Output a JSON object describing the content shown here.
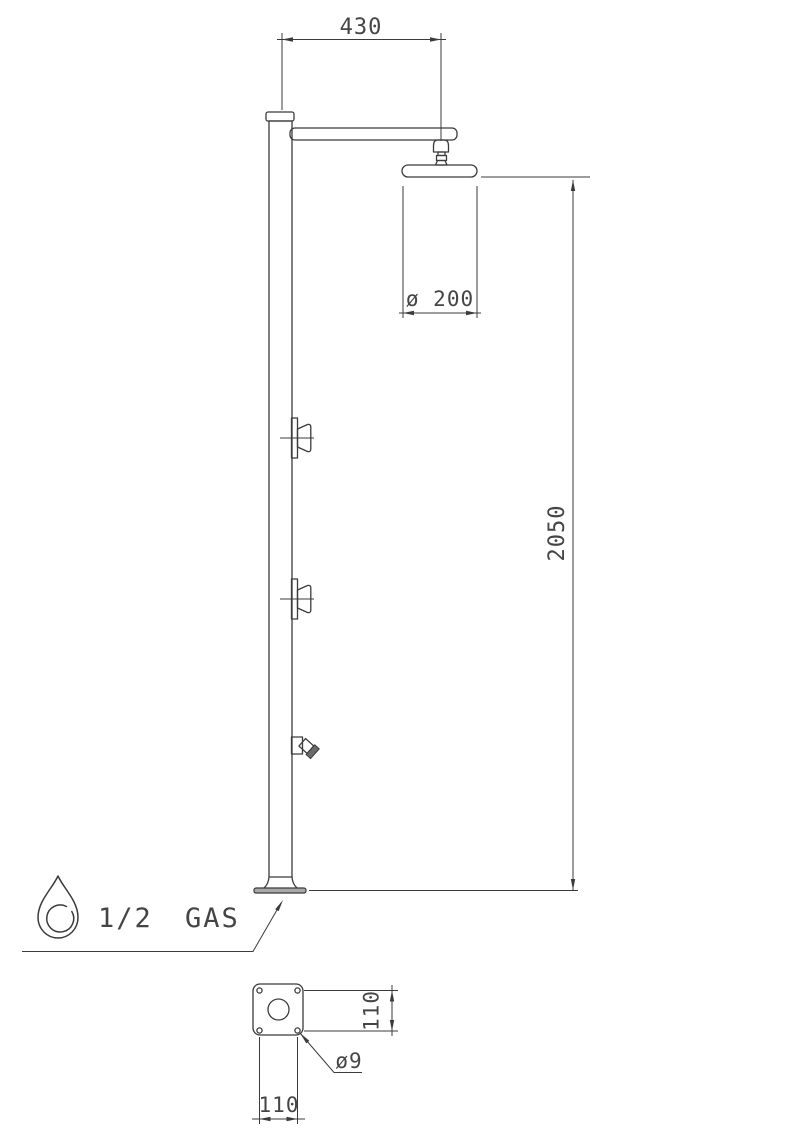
{
  "colors": {
    "background": "#ffffff",
    "line": "#3b3b3b",
    "text": "#454545",
    "plate_fill": "#a8a8a8"
  },
  "drawing": {
    "type": "technical-dimension-drawing",
    "subject": "outdoor shower column, front elevation with base plate plan view",
    "units": "mm",
    "labels": {
      "arm_offset": "430",
      "head_diameter": "ø 200",
      "total_height": "2050",
      "inlet_connection": "1/2 GAS",
      "base_hole_spacing_vertical": "110",
      "base_hole_spacing_horizontal": "110",
      "anchor_hole_diameter": "ø9"
    },
    "icons": {
      "water_inlet": "water-drop-icon"
    }
  }
}
